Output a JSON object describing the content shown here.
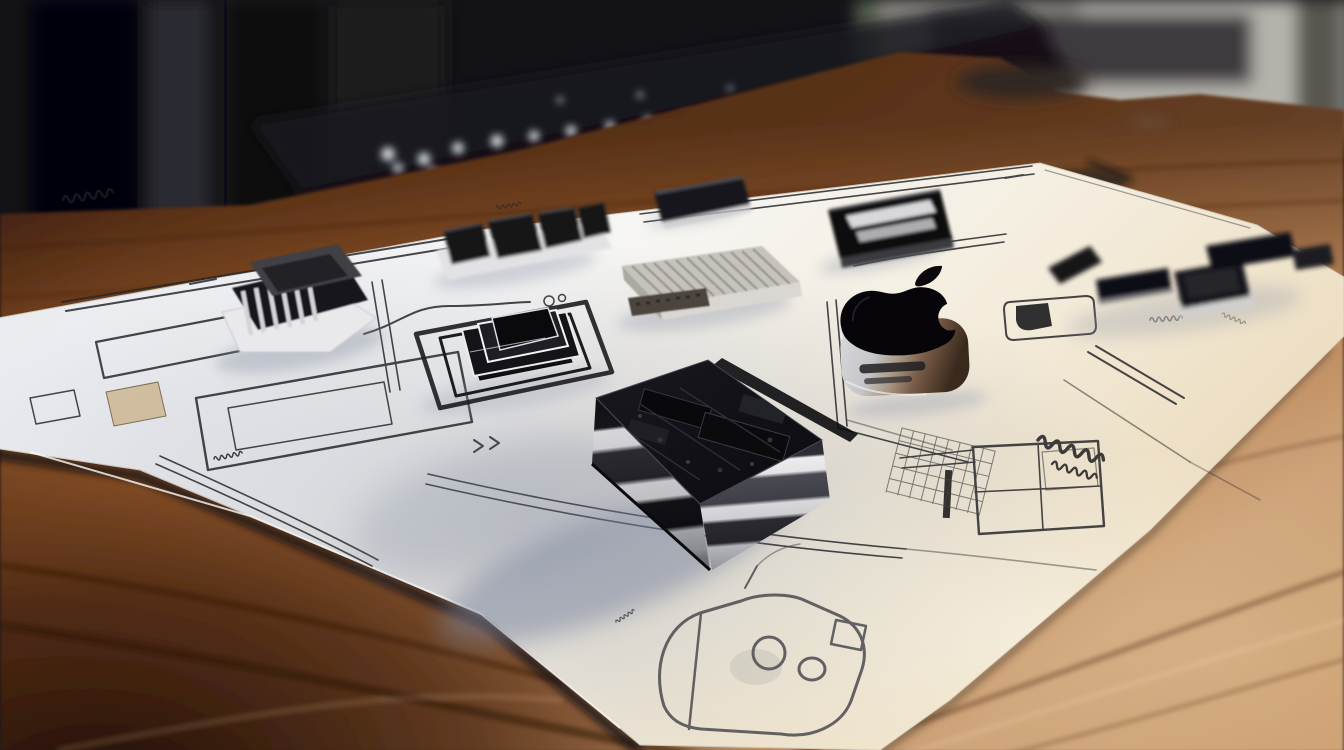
{
  "scene": {
    "type": "photorealistic 3d render, no user interface elements",
    "description": "A white engineering blueprint sheet covered with pencil circuit schematics lies on a warm wooden desk; several black electronic components and a glossy 3D Apple logo sit on the sheet; a blurred dark office with a backlit keyboard and gray shelving fills the background.",
    "text": {
      "legible": false,
      "note": "All markings on the blueprint are illegible pencil scribbles; no readable text appears anywhere in the image."
    },
    "objects": [
      {
        "id": "background",
        "label": "Blurred dark office background"
      },
      {
        "id": "keyboard",
        "label": "Out-of-focus backlit keyboard at the back edge of the desk"
      },
      {
        "id": "shelf",
        "label": "Blurred gray shelf and panels, upper right"
      },
      {
        "id": "desk",
        "label": "Warm brown wooden desk surface with diagonal grain"
      },
      {
        "id": "desk-item",
        "label": "Small blurred dark object lying on the desk"
      },
      {
        "id": "blueprint",
        "label": "White schematic blueprint sheet with pencil drawings"
      },
      {
        "id": "connector-module",
        "label": "Black finned connector module on white base, left"
      },
      {
        "id": "top-connector",
        "label": "Black multi-block connector, upper middle"
      },
      {
        "id": "small-chip",
        "label": "Small black chip package, top center"
      },
      {
        "id": "striped-chip",
        "label": "Black chip with two metallic stripes, top right"
      },
      {
        "id": "heatsink",
        "label": "Silver finned heatsink block"
      },
      {
        "id": "stepped-socket",
        "label": "Stepped black processor socket with nested square outlines"
      },
      {
        "id": "processor-module",
        "label": "Large layered black processor module, center"
      },
      {
        "id": "apple-object",
        "label": "Glossy black 3D Apple logo on a metallic slotted base"
      },
      {
        "id": "component-cluster",
        "label": "Cluster of small black connectors, right edge of sheet"
      },
      {
        "id": "sketch-drawing",
        "label": "Hand-drawn rounded device sketch at the bottom edge of the sheet"
      },
      {
        "id": "schematic-drawings",
        "label": "Pencil schematic line work with illegible annotations"
      }
    ],
    "palette": {
      "background_dark": "#131216",
      "shelf_gray": "#96938d",
      "wood_dark": "#4f2a16",
      "wood_mid": "#a06a3d",
      "wood_light": "#c8a078",
      "paper_white": "#f5f3ee",
      "paper_warm": "#e9d9ba",
      "component_black": "#121215",
      "metal_silver": "#d8d8db",
      "bronze": "#7b5f4a",
      "shadow_blue": "#79839c"
    }
  }
}
